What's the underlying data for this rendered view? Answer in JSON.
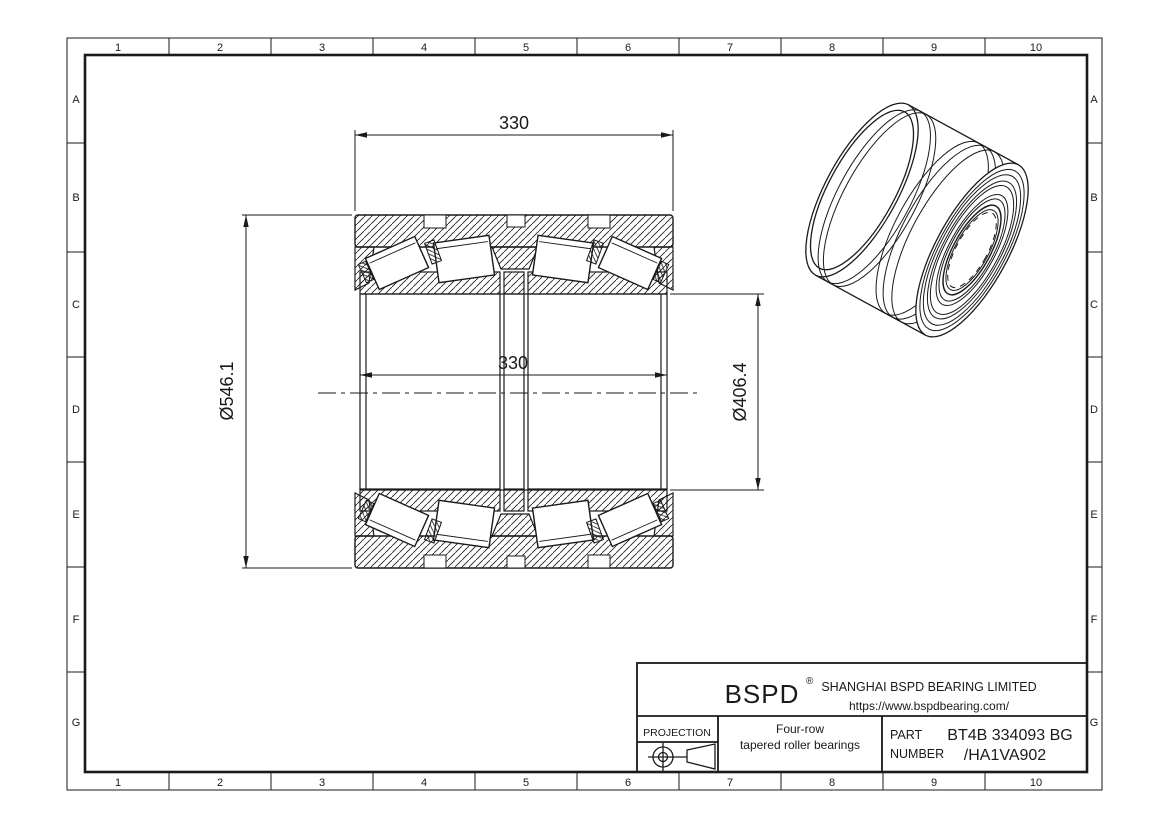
{
  "grid": {
    "cols": [
      "1",
      "2",
      "3",
      "4",
      "5",
      "6",
      "7",
      "8",
      "9",
      "10"
    ],
    "rows": [
      "A",
      "B",
      "C",
      "D",
      "E",
      "F",
      "G"
    ]
  },
  "dims": {
    "top_width": "330",
    "inner_width": "330",
    "outer_dia": "Ø546.1",
    "bore_dia": "Ø406.4"
  },
  "title_block": {
    "brand": "BSPD",
    "registered_mark": "®",
    "company": "SHANGHAI BSPD BEARING LIMITED",
    "website": "https://www.bspdbearing.com/",
    "projection_label": "PROJECTION",
    "product_line1": "Four-row",
    "product_line2": "tapered roller bearings",
    "part_label_line1": "PART",
    "part_label_line2": "NUMBER",
    "part_number_line1": "BT4B 334093 BG",
    "part_number_line2": "/HA1VA902"
  },
  "colors": {
    "line": "#1a1a1a",
    "background": "#ffffff"
  }
}
